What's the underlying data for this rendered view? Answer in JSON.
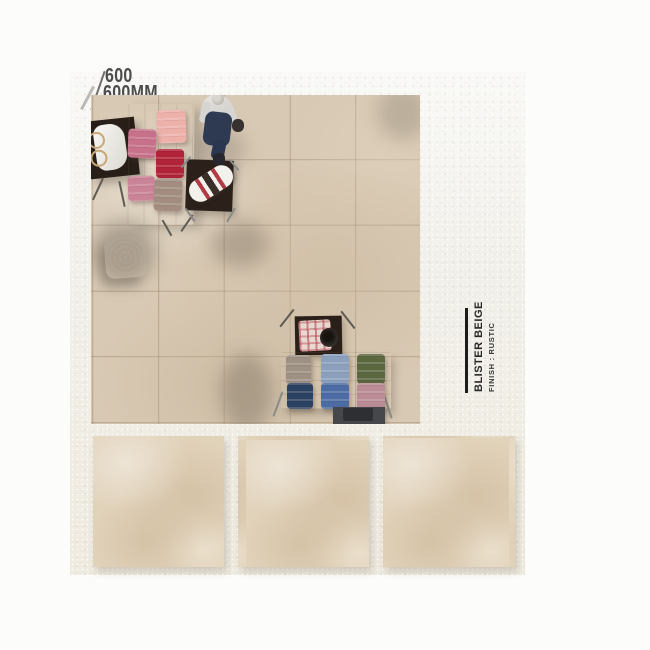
{
  "size_label": {
    "line1": "600",
    "line2": "600MM"
  },
  "product": {
    "name": "BLISTER BEIGE",
    "finish": "FINISH : RUSTIC"
  },
  "swatch_count": "3",
  "colors": {
    "page_bg": "#fcfcfa",
    "wall": "#f2f1ec",
    "floor_tile": "#d8c9b4",
    "grout": "#96806a",
    "swatch_tile": "#e1d2ba",
    "label_text": "#4c4c4c",
    "product_text": "#282828",
    "accent_bar": "#1c1c1c",
    "wood_light": "#cbbaa3",
    "table_dark": "#281f18",
    "bench_gray": "#46474b",
    "pouf_white": "#edebe6",
    "bag_white": "#f3f1ec",
    "strap_red": "#b23a45",
    "stack_pink": "#edb1aa",
    "stack_mauve": "#c7728a",
    "stack_red": "#b02338",
    "stack_dusty_pink": "#c98497",
    "stack_taupe": "#a38d80",
    "stack_taupe2": "#9e9184",
    "stack_denim": "#8ba0bd",
    "stack_olive": "#5b673f",
    "stack_navy": "#2c4263",
    "stack_blue": "#4d6ca3",
    "stack_rose": "#bb8b96",
    "shirt_gray": "#d6d5d1",
    "jeans_navy": "#2e3a51",
    "plaid_base": "#e8d8d2",
    "hat_dark": "#35302c"
  }
}
